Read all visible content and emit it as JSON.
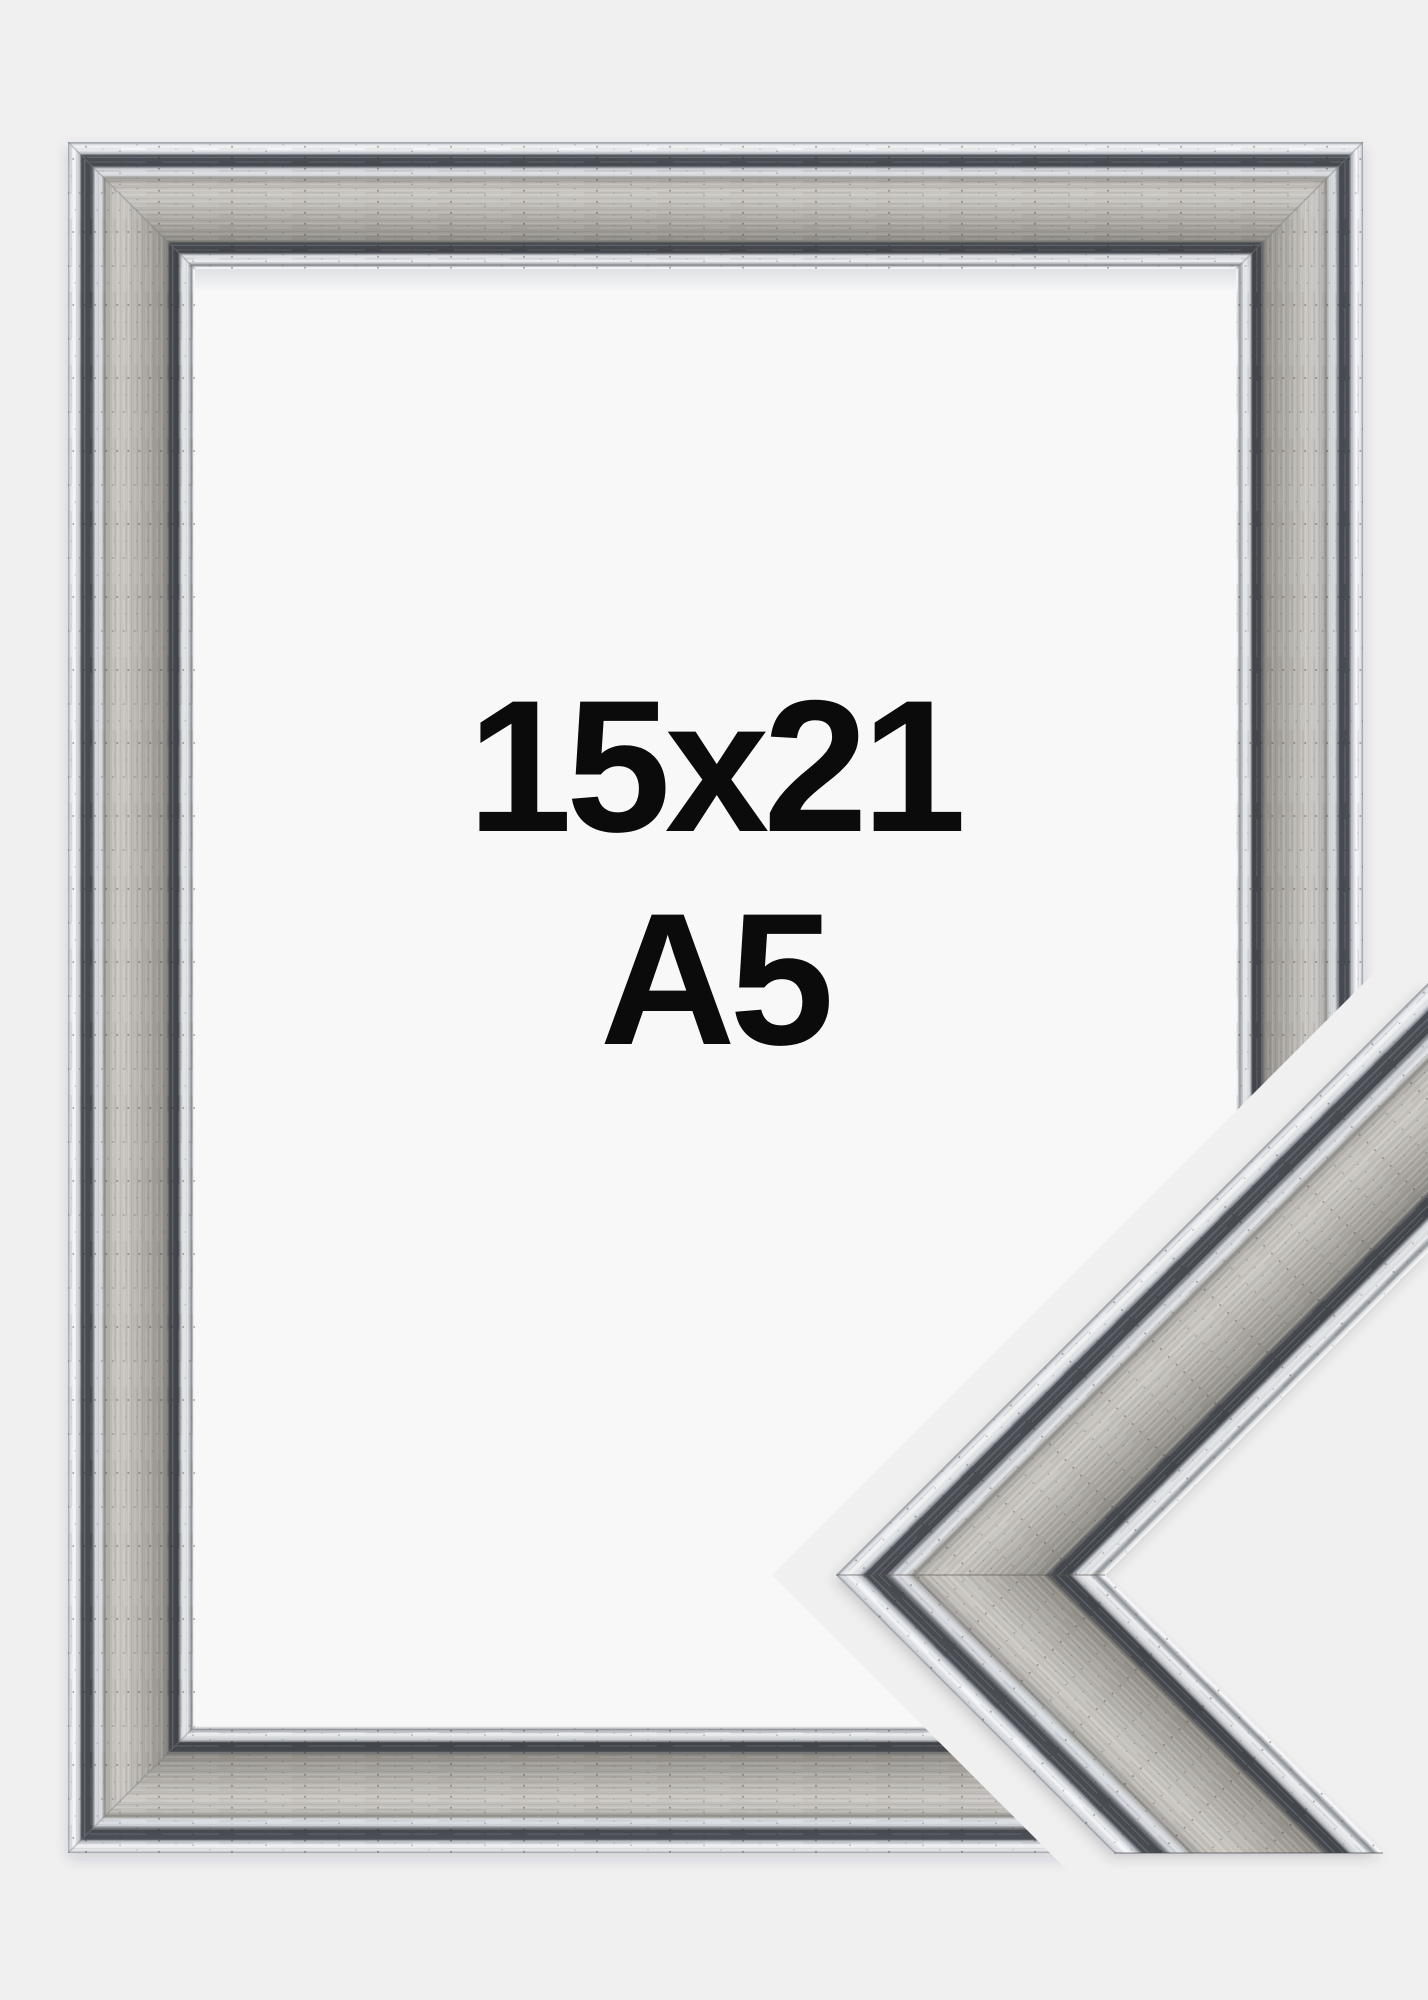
{
  "size_label": {
    "dimensions": "15x21",
    "paper_size": "A5"
  },
  "colors": {
    "background": "#f0f0f1",
    "mat_white": "#f8f8f9",
    "silver_band": "#bdbab4",
    "dark_groove": "#43474d",
    "bright_edge": "#fbfcfd",
    "text": "#0b0b0c"
  }
}
